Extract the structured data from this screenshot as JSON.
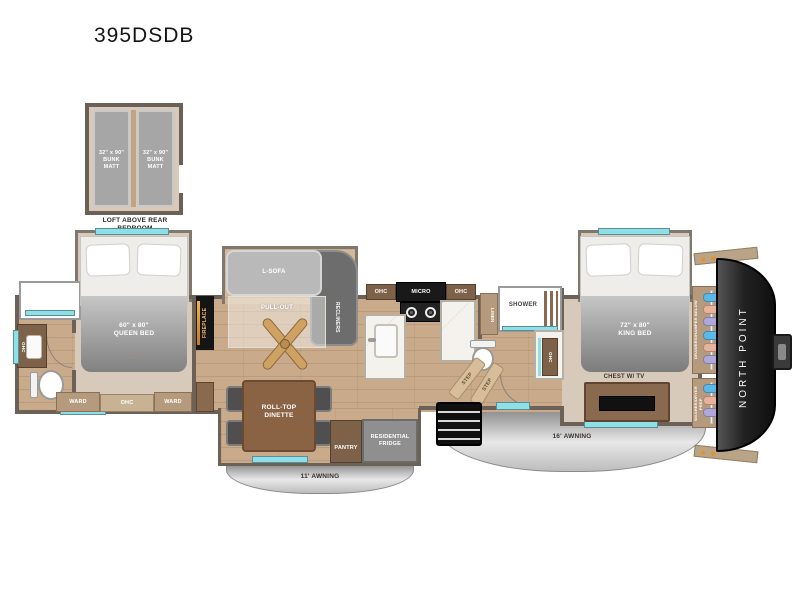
{
  "title": "395DSDB",
  "loft": {
    "bunk_matt": "32\" x 90\"\nBUNK MATT",
    "caption": "LOFT ABOVE REAR\nBEDROOM"
  },
  "rear_bedroom": {
    "queen_bed": "60\" x 80\"\nQUEEN BED",
    "loft": "LOFT",
    "ward": "WARD",
    "ohc": "OHC"
  },
  "rear_bath": {
    "vanity_ohc": "OHC"
  },
  "living_room": {
    "fireplace": "FIREPLACE",
    "l_sofa": "L-SOFA",
    "pull_out": "PULL-OUT",
    "recliners": "RECLINERS"
  },
  "kitchen": {
    "ohc_left": "OHC",
    "micro": "MICRO",
    "ohc_right": "OHC",
    "pantry": "PANTRY",
    "fridge": "RESIDENTIAL\nFRIDGE"
  },
  "dinette": {
    "label": "ROLL-TOP\nDINETTE"
  },
  "mid_bath": {
    "linen": "LINEN",
    "shower": "SHOWER",
    "vanity_ohc": "OHC",
    "step": "STEP"
  },
  "front_bedroom": {
    "king_bed": "72\" x 80\"\nKING BED",
    "chest": "CHEST W/ TV",
    "wardrobe": "DRAWERS/HAMPER BELOW",
    "washer_prep": "WASHER/DRYER PREP"
  },
  "exterior": {
    "awning_small": "11' AWNING",
    "awning_large": "16' AWNING",
    "brand": "NORTH POINT"
  },
  "colors": {
    "wall": "#6b6156",
    "floor_wood": "#c9ab8c",
    "carpet": "#d7cabb",
    "window_glass": "#8fdfe9",
    "front_cap": "#1e1e1e",
    "awning": "#c6c6c6"
  }
}
